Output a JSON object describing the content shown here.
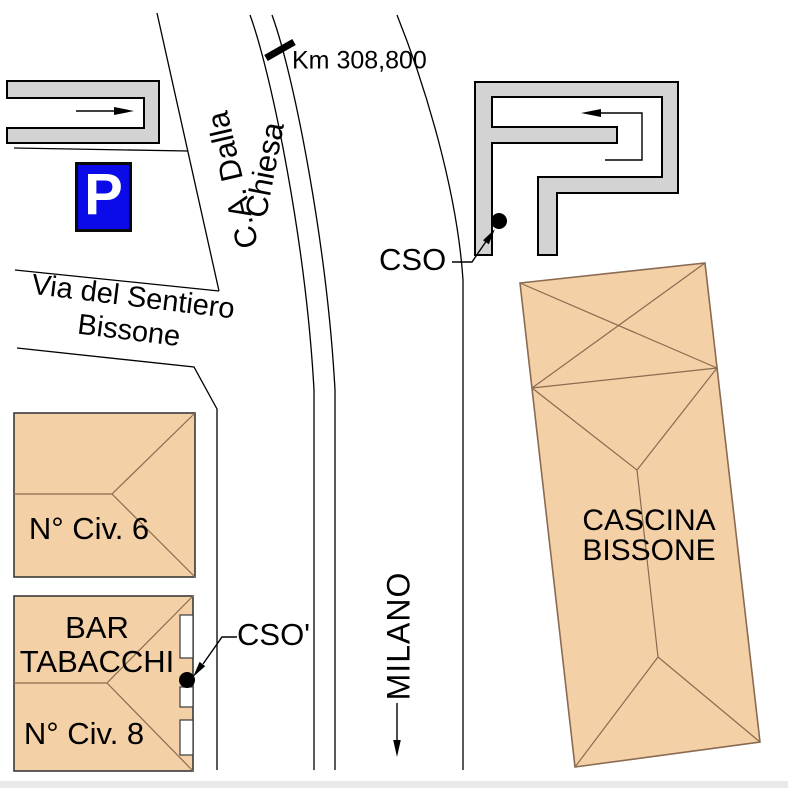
{
  "map": {
    "labels": {
      "km_marker": "Km 308,800",
      "street_diagonal_line1": "C.A. Dalla",
      "street_diagonal_line2": "Chiesa",
      "street_horizontal_line1": "Via del Sentiero",
      "street_horizontal_line2": "Bissone",
      "cso": "CSO",
      "cso_prime": "CSO'",
      "building_civ6": "N° Civ. 6",
      "building_bar_line1": "BAR",
      "building_bar_line2": "TABACCHI",
      "building_civ8": "N° Civ. 8",
      "cascina_line1": "CASCINA",
      "cascina_line2": "BISSONE",
      "direction_milano": "MILANO",
      "parking": "P"
    },
    "colors": {
      "background": "#ffffff",
      "line-black": "#000000",
      "structure-gray": "#d3d3d3",
      "building-fill": "#f4d0a6",
      "building-outline": "#3a3a3a",
      "roof-line": "#8a6b52",
      "parking-blue": "#0b0bea",
      "page-strip": "#e9e9e9"
    }
  }
}
